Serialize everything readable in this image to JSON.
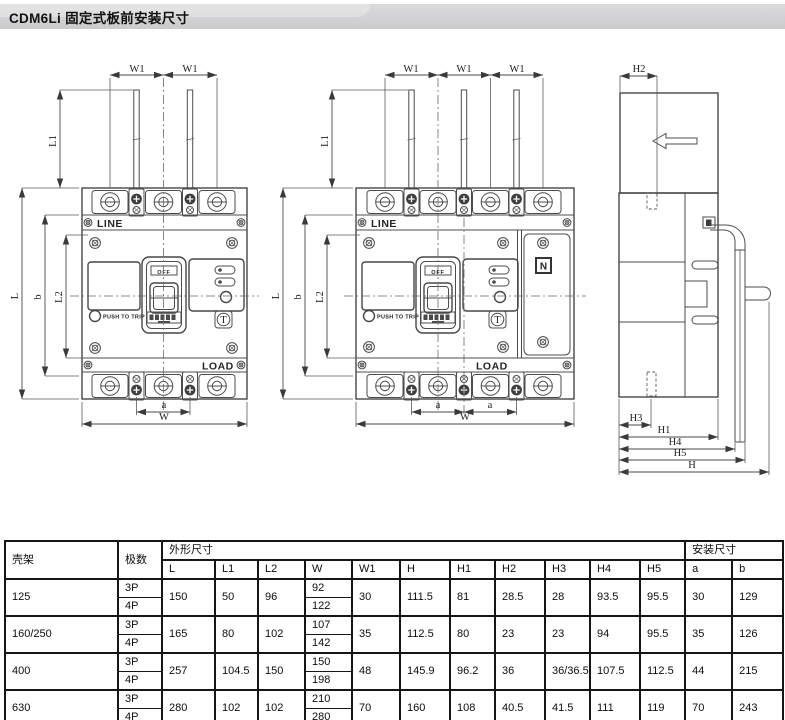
{
  "title": "CDM6Li 固定式板前安装尺寸",
  "drawing": {
    "dims": {
      "W1": "W1",
      "L1": "L1",
      "L": "L",
      "b": "b",
      "L2": "L2",
      "a": "a",
      "W": "W",
      "H": "H",
      "H1": "H1",
      "H2": "H2",
      "H3": "H3",
      "H4": "H4",
      "H5": "H5"
    },
    "labels": {
      "line": "LINE",
      "load": "LOAD",
      "push_to_trip": "PUSH TO TRIP",
      "off": "OFF",
      "test": "T",
      "neutral": "N"
    }
  },
  "table": {
    "frame_header": "壳架",
    "poles_header": "极数",
    "outline_header": "外形尺寸",
    "mounting_header": "安装尺寸",
    "dim_cols": [
      "L",
      "L1",
      "L2",
      "W",
      "W1",
      "H",
      "H1",
      "H2",
      "H3",
      "H4",
      "H5"
    ],
    "mount_cols": [
      "a",
      "b"
    ],
    "p3": "3P",
    "p4": "4P",
    "rows": [
      {
        "frame": "125",
        "L": "150",
        "L1": "50",
        "L2": "96",
        "W_3p": "92",
        "W_4p": "122",
        "W1": "30",
        "H": "111.5",
        "H1": "81",
        "H2": "28.5",
        "H3": "28",
        "H4": "93.5",
        "H5": "95.5",
        "a": "30",
        "b": "129"
      },
      {
        "frame": "160/250",
        "L": "165",
        "L1": "80",
        "L2": "102",
        "W_3p": "107",
        "W_4p": "142",
        "W1": "35",
        "H": "112.5",
        "H1": "80",
        "H2": "23",
        "H3": "23",
        "H4": "94",
        "H5": "95.5",
        "a": "35",
        "b": "126"
      },
      {
        "frame": "400",
        "L": "257",
        "L1": "104.5",
        "L2": "150",
        "W_3p": "150",
        "W_4p": "198",
        "W1": "48",
        "H": "145.9",
        "H1": "96.2",
        "H2": "36",
        "H3": "36/36.5",
        "H4": "107.5",
        "H5": "112.5",
        "a": "44",
        "b": "215"
      },
      {
        "frame": "630",
        "L": "280",
        "L1": "102",
        "L2": "102",
        "W_3p": "210",
        "W_4p": "280",
        "W1": "70",
        "H": "160",
        "H1": "108",
        "H2": "40.5",
        "H3": "41.5",
        "H4": "111",
        "H5": "119",
        "a": "70",
        "b": "243"
      }
    ]
  }
}
